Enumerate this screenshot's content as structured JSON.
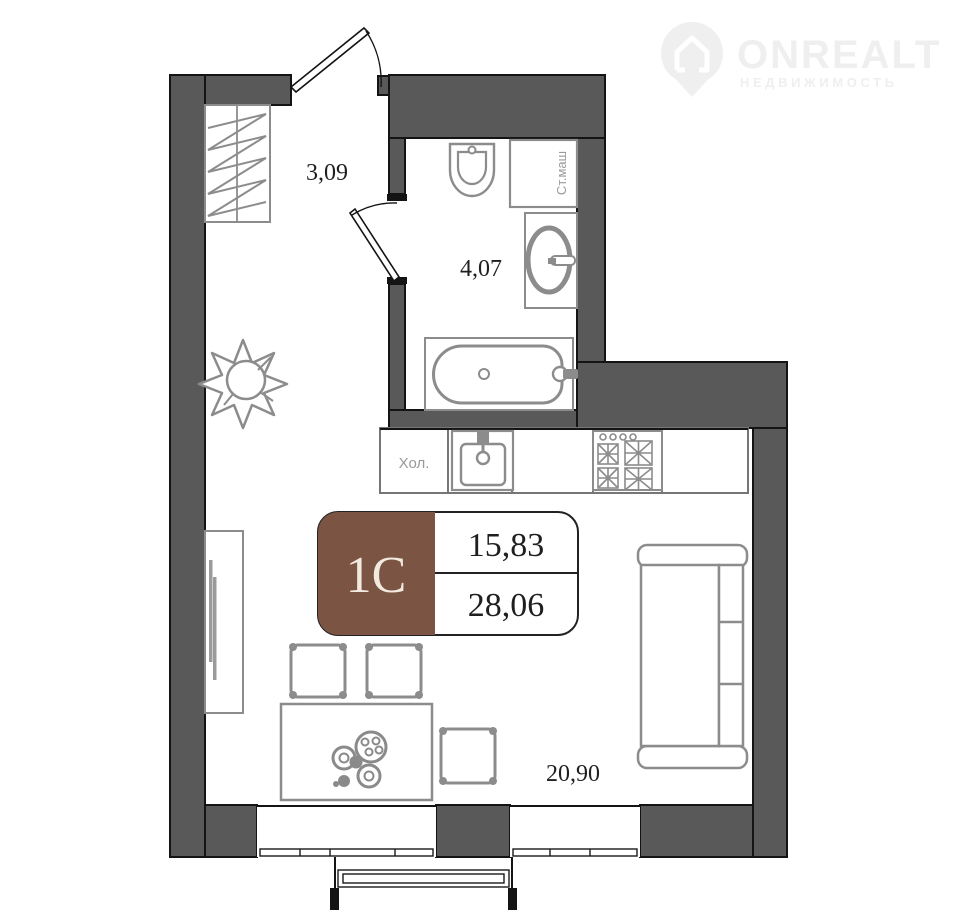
{
  "watermark": {
    "brand": "ONREALT",
    "tagline": "НЕДВИЖИМОСТЬ"
  },
  "badge": {
    "unit": "1С",
    "room_area": "15,83",
    "total_area": "28,06"
  },
  "labels": {
    "hallway_area": "3,09",
    "bathroom_area": "4,07",
    "living_area": "20,90"
  },
  "appliances": {
    "fridge": "Хол.",
    "washer": "Ст.маш"
  },
  "colors": {
    "wall": "#595959",
    "badge_brown": "#7b5444",
    "furniture": "#8c8c8c",
    "watermark": "#efefef",
    "text": "#1f1f1f",
    "applabel": "#9a9a9a"
  }
}
